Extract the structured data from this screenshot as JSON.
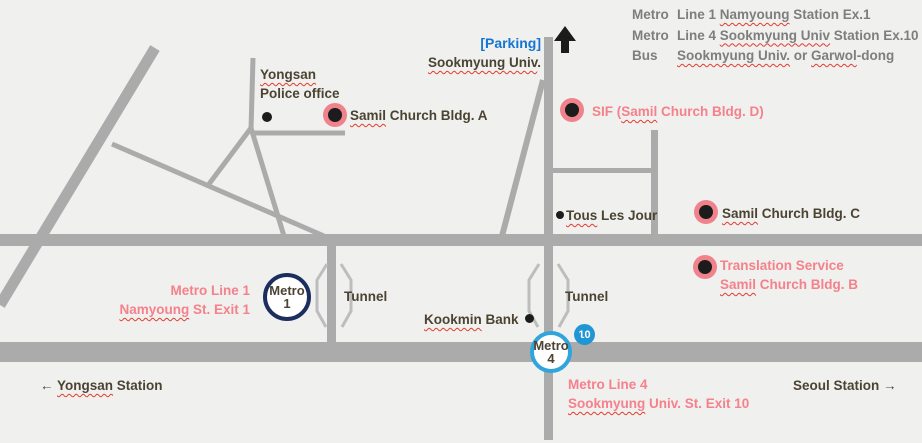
{
  "legend": {
    "rows": [
      {
        "mode": "Metro",
        "t1": "Line 1 ",
        "s1": "Namyoung",
        "t2": " Station Ex.1"
      },
      {
        "mode": "Metro",
        "t1": "Line 4 ",
        "s1": "Sookmyung Univ",
        "t2": " Station Ex.10"
      },
      {
        "mode": "Bus",
        "t1": "",
        "s1": "Sookmyung Univ.",
        "t2": " or ",
        "s2": "Garwol",
        "t3": "-dong"
      }
    ]
  },
  "top": {
    "parking": "[Parking]",
    "campus_s1": "Sookmyung Univ",
    "campus_t2": "."
  },
  "pois": {
    "police_l1": "Yongsan",
    "police_l2": "Police office",
    "bldg_a": {
      "s1": "Samil",
      "t2": " Church Bldg. A"
    },
    "sif": {
      "t1": "SIF (",
      "s1": "Samil",
      "t2": " Church Bldg. D)"
    },
    "tous": {
      "s1": "Tous",
      "t2": " Les Jour"
    },
    "bldg_c": {
      "s1": "Samil",
      "t2": " Church Bldg. C"
    },
    "translation_l1": "Translation Service",
    "translation_l2": {
      "s1": "Samil",
      "t2": " Church Bldg. B"
    },
    "kookmin": {
      "s1": "Kookmin",
      "t2": " Bank"
    }
  },
  "transit": {
    "line1_l1": "Metro Line 1",
    "line1_l2": {
      "s1": "Namyoung",
      "t2": " St. Exit 1"
    },
    "line4_l1": "Metro Line 4",
    "line4_l2": {
      "s1": "Sookmyung",
      "t2": " Univ. St. Exit 10"
    },
    "metro1": {
      "l1": "Metro",
      "l2": "1"
    },
    "metro4": {
      "l1": "Metro",
      "l2": "4"
    },
    "badge10": "10",
    "tunnel1": "Tunnel",
    "tunnel2": "Tunnel"
  },
  "edges": {
    "yongsan": {
      "t1": "← ",
      "s1": "Yongsan",
      "t2": " Station"
    },
    "seoul": "Seoul Station →"
  },
  "colors": {
    "background": "#f0f0ee",
    "road": "#ababab",
    "dark_text": "#4b4433",
    "pink_text": "#f5818b",
    "blue_text": "#1576d2",
    "legend_gray": "#7e7e7e",
    "metro1_ring": "#1c2e5e",
    "metro4_ring": "#2fa5db",
    "badge_blue": "#2097d4",
    "marker_ring": "#f0828c",
    "squiggle_red": "#e23b2e"
  }
}
